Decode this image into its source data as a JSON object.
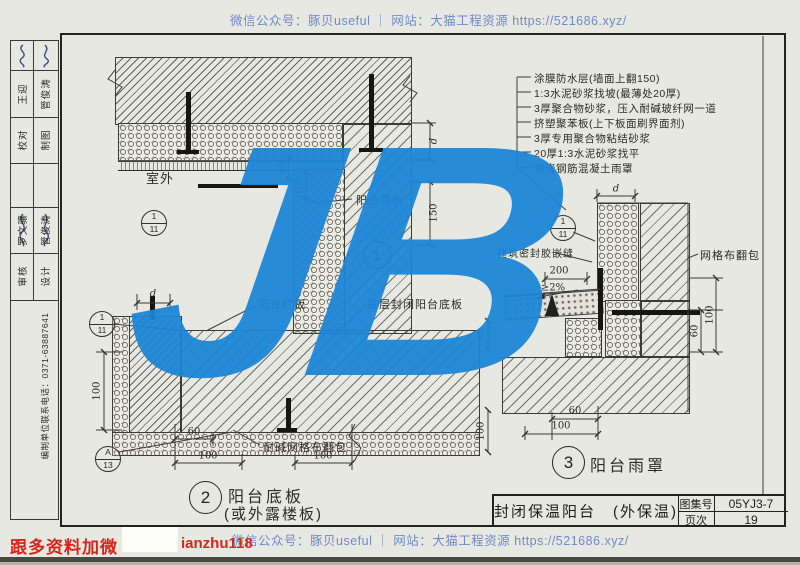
{
  "watermarks": {
    "top": "微信公众号：豚贝useful ｜ 网站：大猫工程资源 https://521686.xyz/",
    "bottom": "微信公众号：豚贝useful ｜ 网站：大猫工程资源 https://521686.xyz/",
    "logo": "JB",
    "logo_color": "#1d86d8",
    "text_color": "#5b79c5"
  },
  "promo": {
    "lead": "跟多资料加微",
    "handle": "ianzhu118",
    "color": "#d6251d"
  },
  "sidebar": {
    "rows": [
      {
        "left": "",
        "right": ""
      },
      {
        "left": "王迎",
        "right": "管俊涛"
      },
      {
        "left": "校对",
        "right": "制图"
      },
      {
        "left": "",
        "right": ""
      },
      {
        "left": "罗文骧",
        "right": "管俊涛"
      },
      {
        "left": "审核",
        "right": "设计"
      }
    ],
    "phone": "编制单位联系电话：0371-63887641"
  },
  "notes": [
    "涂膜防水层(墙面上翻150)",
    "1:3水泥砂浆找坡(最薄处20厚)",
    "3厚聚合物砂浆，压入耐碱玻纤网一道",
    "挤塑聚苯板(上下板面刷界面剂)",
    "3厚专用聚合物粘结砂浆",
    "20厚1:3水泥砂浆找平",
    "现浇钢筋混凝土雨罩"
  ],
  "detail1": {
    "num": "1",
    "room": "室外",
    "slab_label": "阳台顶板",
    "dim_d": "d",
    "dim_150": "150",
    "dim_60": "60",
    "dim_100": "100",
    "marker": {
      "top": "1",
      "bottom": "11"
    }
  },
  "detail2": {
    "num": "2",
    "caption1": "阳台底板",
    "caption2": "(或外露楼板)",
    "railing_label": "阳台栏板",
    "floor_label": "首层封闭阳台底板",
    "mesh_label": "耐碱网格布翻包",
    "dim_d": "d",
    "dim_100_left": "100",
    "dim_60": "60",
    "dim_100_a": "100",
    "dim_100_b": "100",
    "marker_section": {
      "top": "1",
      "bottom": "11"
    },
    "marker_node": {
      "top": "A",
      "bottom": "13"
    }
  },
  "detail3": {
    "num": "3",
    "caption": "阳台雨罩",
    "sealant_label": "建筑密封胶嵌缝",
    "mesh_label": "网格布翻包",
    "dim_200": "200",
    "slope": "≥2%",
    "dim_d_top": "d",
    "dim_100_right": "100",
    "dim_60_right": "60",
    "dim_60_bottom": "60",
    "dim_100_bottom": "100",
    "dim_d_left": "d",
    "dim_100_left": "100",
    "marker": {
      "top": "1",
      "bottom": "11"
    }
  },
  "title_block": {
    "title": "封闭保温阳台　(外保温)",
    "atlas_label": "图集号",
    "atlas_no": "05YJ3-7",
    "page_label": "页次",
    "page_no": "19"
  }
}
